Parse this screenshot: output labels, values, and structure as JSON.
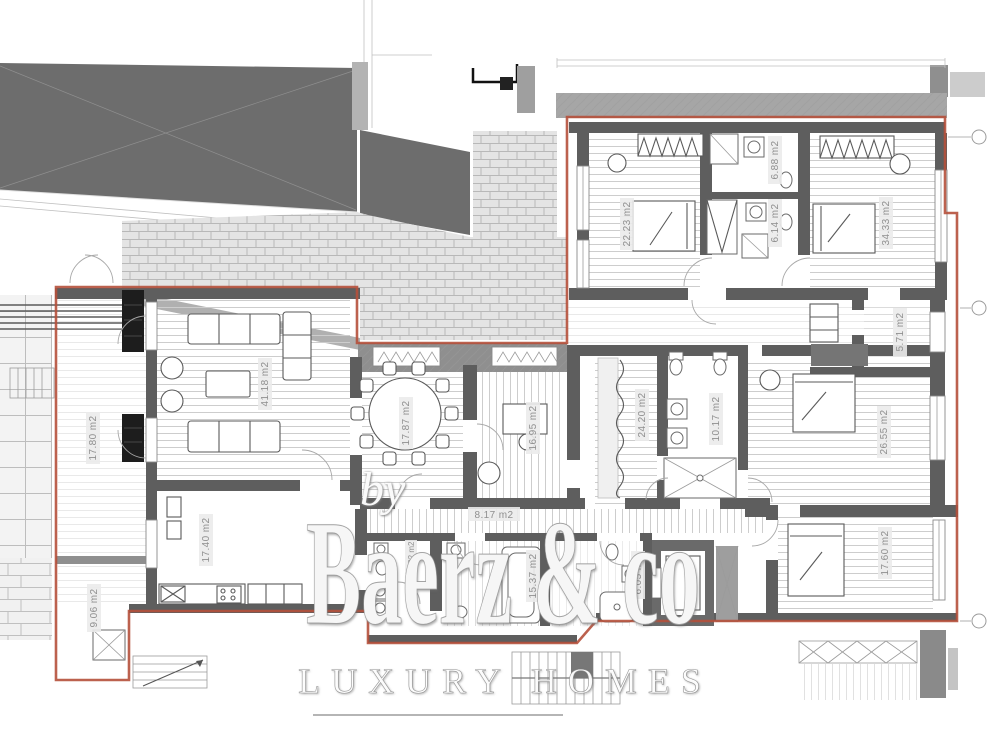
{
  "image": {
    "width": 1000,
    "height": 750,
    "background": "#ffffff",
    "description": "architectural floor plan of a luxury apartment"
  },
  "watermark": {
    "by": "by",
    "brand": "Baerz & co",
    "tagline": "LUXURY HOMES",
    "text_color": "#ffffff"
  },
  "plan": {
    "boundary_color": "#b5503b",
    "wall_color": "#5e5e5e",
    "area_unit": "m2",
    "section_markers": 3,
    "rooms": [
      {
        "id": "terrace-left",
        "label": "17.80 m2"
      },
      {
        "id": "living-room",
        "label": "41.18 m2"
      },
      {
        "id": "dining-room",
        "label": "17.87 m2"
      },
      {
        "id": "study",
        "label": "16.95 m2"
      },
      {
        "id": "kitchen",
        "label": "17.40 m2"
      },
      {
        "id": "storage-terrace",
        "label": "9.06 m2"
      },
      {
        "id": "hallway",
        "label": "8.17 m2"
      },
      {
        "id": "bedroom-2",
        "label": "22.23 m2"
      },
      {
        "id": "bathroom-1",
        "label": "6.88 m2"
      },
      {
        "id": "bathroom-2",
        "label": "6.14 m2"
      },
      {
        "id": "master-bedroom",
        "label": "34.33 m2"
      },
      {
        "id": "walk-in-closet",
        "label": "5.71 m2"
      },
      {
        "id": "inner-hall",
        "label": "24.20 m2"
      },
      {
        "id": "master-bathroom",
        "label": "10.17 m2"
      },
      {
        "id": "bedroom-3",
        "label": "26.55 m2"
      },
      {
        "id": "bedroom-4",
        "label": "17.60 m2"
      },
      {
        "id": "bathroom-3",
        "label": "15.37 m2"
      },
      {
        "id": "bathroom-4",
        "label": "6.05 m2"
      },
      {
        "id": "wc",
        "label": "2.92 m2"
      }
    ]
  }
}
